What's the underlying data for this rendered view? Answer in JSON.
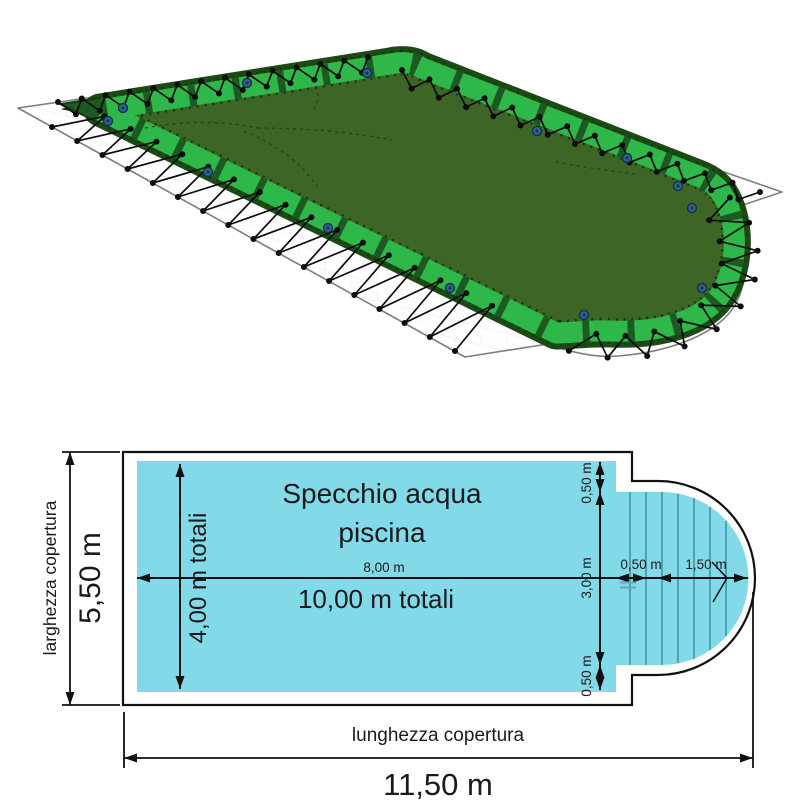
{
  "illustration": {
    "alt": "winter pool cover with inflatable tube border, rope lacing and ground sheet",
    "colors": {
      "tarp": "#3c6526",
      "tube": "#2eb84a",
      "tube_dark": "#1b4a15",
      "sheet_outline": "#7d7d7d",
      "rope": "#0d0d0d",
      "valve": "#33628e"
    }
  },
  "diagram": {
    "title_line1": "Specchio acqua",
    "title_line2": "piscina",
    "labels": {
      "cover_width": "larghezza copertura",
      "cover_width_value": "5,50 m",
      "cover_length": "lunghezza copertura",
      "cover_length_value": "11,50 m",
      "pool_width_total": "4,00 m totali",
      "pool_rect_length": "8,00 m",
      "pool_length_total": "10,00 m totali",
      "edge_top": "0,50 m",
      "edge_mid": "3,00 m",
      "edge_bottom": "0,50 m",
      "roman_step": "0,50 m",
      "roman_radius": "1,50 m"
    },
    "colors": {
      "water": "#82d9e8",
      "step_line": "#2f8596",
      "line": "#111111"
    }
  }
}
